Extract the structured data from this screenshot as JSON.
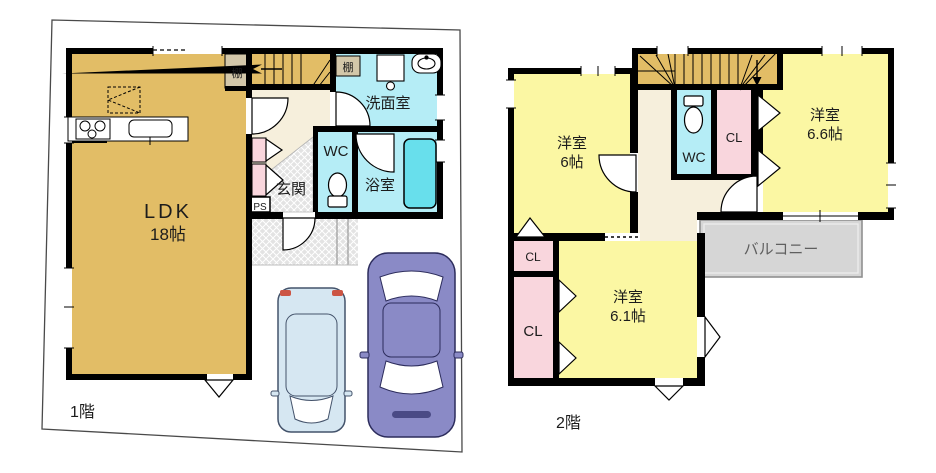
{
  "floor1": {
    "label": "1階",
    "ldk_name": "LDK",
    "ldk_size": "18帖",
    "genkan": "玄関",
    "wc": "WC",
    "washroom": "洗面室",
    "bathroom": "浴室",
    "shelf_ldk": "棚",
    "shelf_washroom": "棚",
    "ps": "PS"
  },
  "floor2": {
    "label": "2階",
    "west_name": "洋室",
    "west_size": "6帖",
    "east_name": "洋室",
    "east_size": "6.6帖",
    "south_name": "洋室",
    "south_size": "6.1帖",
    "wc": "WC",
    "cl_wc": "CL",
    "cl_upper": "CL",
    "cl_lower": "CL",
    "balcony": "バルコニー"
  },
  "colors": {
    "wall": "#000000",
    "ldk_tan": "#e2bd66",
    "stairs_tan": "#e2bd66",
    "room_yellow": "#fbf7a3",
    "water_cyan": "#b5edf6",
    "bathtub_cyan": "#68dfec",
    "closet_pink": "#f9d6dd",
    "hall_cream": "#f6efdc",
    "shelf_beige": "#d3c7a9",
    "balcony_gray": "#d6d6d6",
    "car_blue": "#d6e7f2",
    "car_purple": "#8a8ac6"
  }
}
